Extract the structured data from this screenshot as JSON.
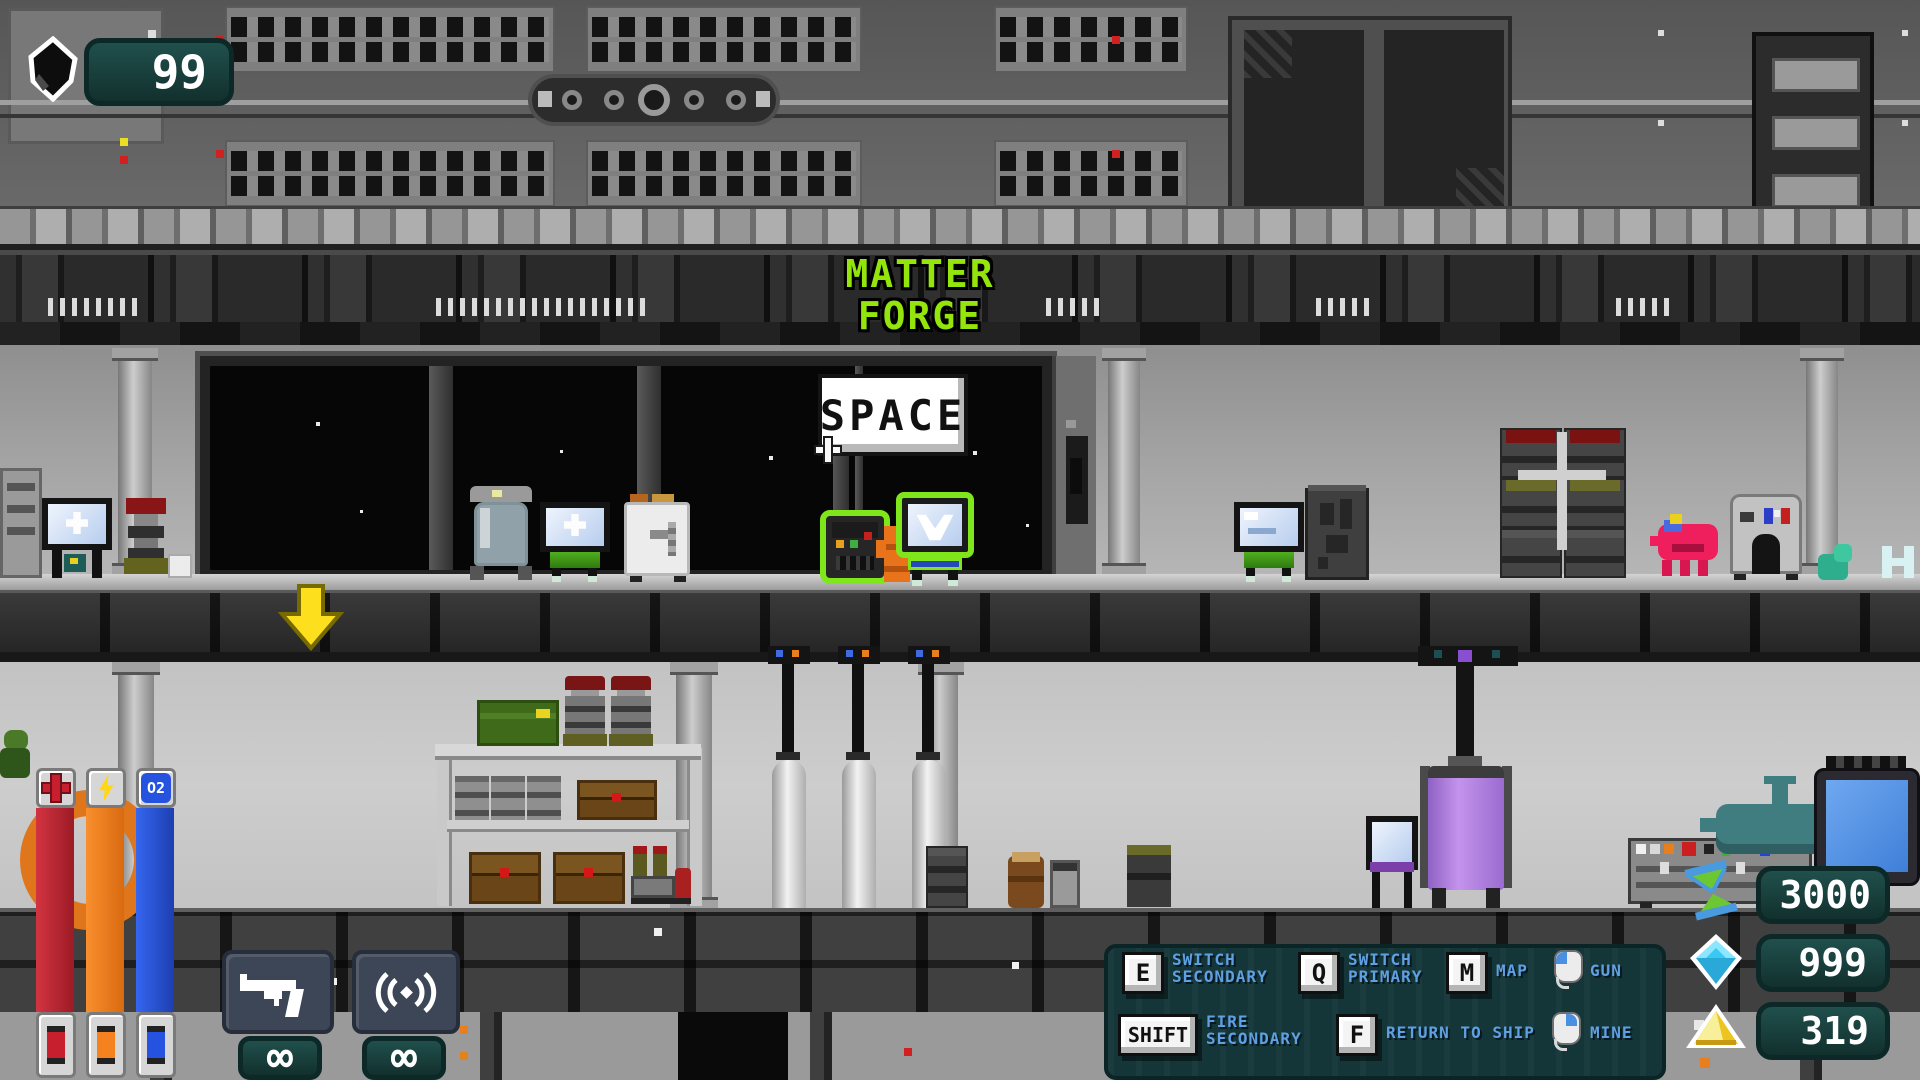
{
  "hud": {
    "ore_counter": {
      "icon": "ore-chunk-icon",
      "value": "99"
    },
    "location": {
      "line1": "MATTER",
      "line2": "FORGE"
    },
    "bars": [
      {
        "id": "health",
        "icon": "health-cross-icon"
      },
      {
        "id": "energy",
        "icon": "energy-bolt-icon"
      },
      {
        "id": "oxygen",
        "icon": "oxygen-icon",
        "icon_text": "O2"
      }
    ],
    "weapons": [
      {
        "id": "pistol",
        "icon": "pistol-icon",
        "ammo": "∞"
      },
      {
        "id": "signal-emitter",
        "icon": "signal-waves-icon",
        "ammo": "∞"
      }
    ],
    "keybinds": [
      {
        "key": "E",
        "line1": "SWITCH",
        "line2": "SECONDARY"
      },
      {
        "key": "Q",
        "line1": "SWITCH",
        "line2": "PRIMARY"
      },
      {
        "key": "M",
        "line1": "MAP",
        "line2": ""
      },
      {
        "key": "",
        "mouse": "left",
        "line1": "GUN",
        "line2": ""
      },
      {
        "key": "SHIFT",
        "line1": "FIRE",
        "line2": "SECONDARY"
      },
      {
        "key": "F",
        "line1": "RETURN TO SHIP",
        "line2": ""
      },
      {
        "key": "",
        "mouse": "right",
        "line1": "MINE",
        "line2": ""
      }
    ],
    "resources": [
      {
        "id": "time",
        "icon": "hourglass-icon",
        "value": "3000"
      },
      {
        "id": "gems",
        "icon": "diamond-icon",
        "value": "999"
      },
      {
        "id": "gold",
        "icon": "pyramid-icon",
        "value": "319"
      }
    ]
  },
  "scene": {
    "sign_text": "SPACE",
    "highlighted_objects": [
      "robot-companion",
      "terminal-character"
    ]
  },
  "colors": {
    "hud_panel_teal": "#143638",
    "keybind_label_blue": "#5fa0e2",
    "location_green": "#93e50c",
    "health_red": "#bf2531",
    "energy_orange": "#f5821e",
    "oxygen_blue": "#2553df",
    "highlight_green": "#7fe61c"
  }
}
